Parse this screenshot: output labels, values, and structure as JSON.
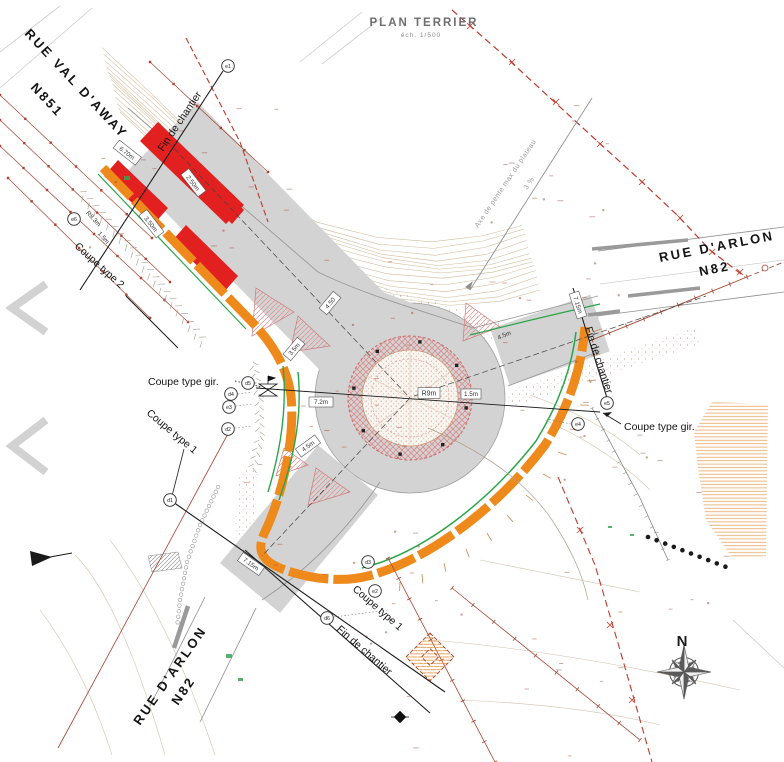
{
  "title": {
    "main": "PLAN TERRIER",
    "scale": "éch. 1/500"
  },
  "streets": {
    "nw": {
      "name": "RUE VAL D'AWAY",
      "ref": "N851"
    },
    "ne": {
      "name": "RUE D'ARLON",
      "ref": "N82"
    },
    "sw": {
      "name": "RUE D'ARLON",
      "ref": "N82"
    }
  },
  "sections": {
    "coupe_gir_left": "Coupe type gir.",
    "coupe_gir_right": "Coupe type gir.",
    "coupe_1_left": "Coupe type 1",
    "coupe_1_bottom": "Coupe type 1",
    "coupe_2": "Coupe type 2",
    "fin_nw": "Fin de chantier",
    "fin_e": "Fin de chantier",
    "fin_s": "Fin de chantier"
  },
  "slope_axis": {
    "label": "Axe de pente max du plateau",
    "value": "3 %"
  },
  "dimensions": {
    "box_670": "6.70m",
    "red_250": "2.50m",
    "red_350": "3.50m",
    "r83": "R8.3m",
    "w15_nw": "1.5m",
    "w72": "7.2m",
    "w45_sw": "4.5m",
    "isl_35": "3.5m",
    "isl_450": "4.50",
    "r9": "R9m",
    "w15_c": "1.5m",
    "w45_ne": "4.5m",
    "w715_e": "7.15m",
    "w715_s": "7.15m"
  },
  "markers": {
    "e1": "e1",
    "e2": "e2",
    "e3": "e3",
    "e4": "e4",
    "e5": "e5",
    "e6": "e6",
    "d1": "d1",
    "d2": "d2",
    "d3": "d3",
    "d4": "d4",
    "d5": "d5",
    "d6": "d6"
  },
  "compass": {
    "north": "N"
  },
  "colors": {
    "road_gray": "#d3d3d3",
    "curb_orange": "#ee8a1c",
    "works_red": "#e32020",
    "edge_green": "#2ba54a",
    "survey_brown": "#a2442e",
    "boundary_red": "#bf3b2b",
    "contour_tan": "#c9ae8a"
  }
}
